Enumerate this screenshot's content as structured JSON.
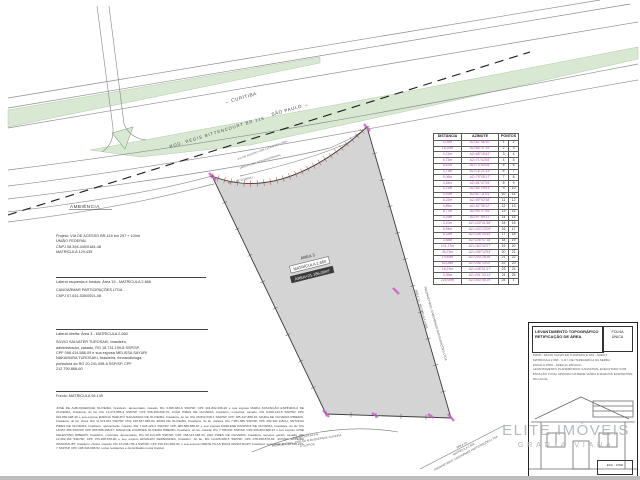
{
  "colors": {
    "accent_magenta": "#b44fb4",
    "road_green": "#d9e8d2",
    "parcel_gray": "#d4d4d4",
    "watermark_gray": "#a9aeb4",
    "hatch_red": "#b03535"
  },
  "road": {
    "curitiba_label": "← CURITIBA",
    "sao_paulo_label": "SÃO PAULO →",
    "highway_label": "ROD. RÉGIS BITTENCOURT   BR 116",
    "ambiencia_label": "AMBIÊNCIA",
    "access_road_label_1": "VIA DE ACESSO A BR-116 KM 297+100m",
    "access_road_label_2": "(ÁREA A SER DESAPROPRIADA)",
    "faixa_label": "FAIXA DE DOMÍNIO"
  },
  "parcel": {
    "area_name": "ÁREA 3",
    "matricula": "MATRÍCULA 2.660",
    "area_value": "ÁREA=21.186,00m²",
    "right_label_1": "ÁREA 19 - MATRÍCULA 2.666",
    "right_label_2": "PROPRIETÁRIO: CANOARMAR PARTICIPAÇÕES LTDA",
    "bottom_left_label_1": "MATRÍCULA 94.149",
    "bottom_left_label_2": "PROPRIETÁRIO: JOSÉ DE ALBUQUERQUE OLIVEIRA",
    "bottom_left_label_3": "E OUTROS",
    "bottom_right_label_1": "ÁREA 19",
    "bottom_right_label_2": "MATRÍCULA 2.666",
    "bottom_right_label_3": "PROPRIETÁRIO: CANOARMAR PARTICIPAÇÕES LTDA"
  },
  "survey_table": {
    "headers": [
      "DISTÂNCIA",
      "AZIMUTE",
      "PONTOS"
    ],
    "rows": [
      [
        "4,05m",
        "AZ=62°58'10\"",
        "1",
        "2"
      ],
      [
        "16,39m",
        "AZ=65°37'15\"",
        "2",
        "3"
      ],
      [
        "4,21m",
        "AZ=68°18'42\"",
        "3",
        "4"
      ],
      [
        "6,73m",
        "AZ=71°02'55\"",
        "4",
        "5"
      ],
      [
        "8,87m",
        "AZ=73°44'08\"",
        "5",
        "6"
      ],
      [
        "3,73m",
        "AZ=76°21'33\"",
        "6",
        "7"
      ],
      [
        "5,06m",
        "AZ=79°05'17\"",
        "7",
        "8"
      ],
      [
        "4,64m",
        "AZ=81°47'26\"",
        "8",
        "9"
      ],
      [
        "5,21m",
        "AZ=84°29'51\"",
        "9",
        "10"
      ],
      [
        "4,49m",
        "AZ=87°11'04\"",
        "10",
        "11"
      ],
      [
        "6,22m",
        "AZ=89°53'38\"",
        "11",
        "12"
      ],
      [
        "4,89m",
        "AZ=92°35'12\"",
        "12",
        "13"
      ],
      [
        "6,77m",
        "AZ=95°17'45\"",
        "13",
        "14"
      ],
      [
        "4,29m",
        "AZ=97°59'21\"",
        "14",
        "15"
      ],
      [
        "3,10m",
        "AZ=100°41'56\"",
        "15",
        "16"
      ],
      [
        "5,94m",
        "AZ=103°23'09\"",
        "16",
        "17"
      ],
      [
        "8,33m",
        "AZ=106°05'44\"",
        "17",
        "18"
      ],
      [
        "3,88m",
        "AZ=108°47'18\"",
        "18",
        "19"
      ],
      [
        "101,17m",
        "AZ=163°40'27\"",
        "19",
        "20"
      ],
      [
        "36,23m",
        "AZ=196°12'53\"",
        "20",
        "21"
      ],
      [
        "19,85m",
        "AZ=243°28'36\"",
        "21",
        "22"
      ],
      [
        "52,08m",
        "AZ=246°10'02\"",
        "22",
        "23"
      ],
      [
        "16,23m",
        "AZ=248°51'47\"",
        "23",
        "24"
      ],
      [
        "3,36m",
        "AZ=251°33'14\"",
        "24",
        "25"
      ],
      [
        "228,69m",
        "AZ=343°55'29\"",
        "25",
        "1"
      ]
    ]
  },
  "left_column": {
    "project_lines": [
      "Projeto: VIA DE ACESSO BR-116 km 297 + 100m",
      "UNIÃO FEDERAL",
      "CNPJ 08.394.440/0184-48",
      "MATRÍCULA 129.439"
    ],
    "left_side_title": "Lateral esquerda e fundos: Área 19 - MATRÍCULA 2.666",
    "left_side_lines": [
      "CANOARMAR PARTICIPAÇÕES LTDA",
      "CNPJ 07.631.535/0001-08"
    ],
    "right_side_title": "Lateral direita: Área 3  -  MATRÍCULA 2.660",
    "right_side_lines": [
      "SILVIO SALVATER TUROSAKI, brasileiro,",
      "administrador, casado, RG 18.731.199-8 SSP/SP,",
      "CPF 098.414.588-09 e sua esposa MELISSA SAYURI",
      "NAKAMURA TUROSAKI, brasileira, fonoaudióloga,",
      "portadora do RG 20.241.098-8 SSP/SP, CPF",
      "212.790.868-60"
    ],
    "back_title": "Fundo: MATRÍCULA 94.149",
    "owners_paragraph": "JOSÉ DE ALBUQUERQUE OLIVEIRA, brasileiro, aposentado, casado, RG 3.008.366-6 SSP/SP, CPF 201.832.268-20 e sua esposa MARIA ASSUNÇÃO ESPÍNDOLA DE OLIVEIRA, brasileira, do lar, RG 13.373.885-3 SSP/SP, CPF 008.368.608-76; JOÃO PIRES DE OLIVEIRA, brasileiro, motorista, casado, RG 9.098.134-8 SSP/SP, CPF 042.830.028-40 e sua esposa MARCIA HARUKO NAKAMURA DE OLIVEIRA, brasileira, do lar, RG 25.832.048-1 SSP/SP, CPF 185.447.888-16; MARIA DE OLIVEIRA RIBEIRO, brasileira, do lar, viúva, RG 11.674.811 SSP/SP, CPF 248.637.838-90; EDNA DE OLIVEIRA, brasileira, do lar, solteira, RG 7.951.389 SSP/SP, CPF 052.931.118-01; ANTONIO PIRES DE OLIVEIRA, brasileiro, aposentado, casado, RG 7.943.129-2 SSP/SP, CPF 085.588.588-87 e sua esposa MARLENE RANZONI DE OLIVEIRA, brasileira, do lar, RG 18.957.388 SSP/SP, CPF 085.588.188-67; MARIA DE LOURDES OLIVEIRA RIBEIRO, brasileira, do lar, casada, RG 7.788.091 SSP/SP, CPF 006.803.888-97 e seu esposo JOSÉ CELESTINO RIBEIRO, brasileiro, motorista, aposentado, RG 08.113.188 SSP/SP, CPF 168.113.188-34; ANA PIRES DE OLIVEIRA, brasileira, serviços gerais, casada, RG 12.382.162 SSP/SP, CPF 079.208.878-80 e seu esposo EDVALDO FERNANDES, brasileiro, do lar, RG 14.026.088-5 SSP/SP, CPF 078.208.878-92; JOVINO SILVEIRA WASCHAUPT, brasileiro, chofer, casado, RG 10.248.735-4 SSP/SP, CPF 156.341.608-30, e sua esposa ODETE VILAS BOAS WASCHAUPT, brasileira, secretária, RG 12.480.215-7 SSP/SP, CPF 198.346.608-52, todos residentes e domiciliados nesta Capital."
  },
  "title_block": {
    "title_line1": "LEVANTAMENTO TOPOGRÁFICO",
    "title_line2": "RETIFICAÇÃO DE ÁREA",
    "sheet_label": "FOLHA",
    "sheet_value": "ÚNICA",
    "notes": [
      "PROP.: SILVIO SALVATER TUROSAKI E S/M - ÁREA 3",
      "MATRÍCULA 2.660 - C.R.I. DE ITAPECERICA DA SERRA",
      "ESCALA 1/500 - ÁREA 21.186,00m²",
      "LEVANTAMENTO PLANIMÉTRICO CADASTRAL EXECUTADO COM ESTAÇÃO TOTAL APOIADO NA REDE VIÁRIA E MARCOS EXISTENTES NO LOCAL"
    ],
    "scale_value": "ESC.: 1/500"
  },
  "watermark": {
    "line1": "ELITE IMÓVEIS",
    "line2": "GRANJA VIANA"
  }
}
